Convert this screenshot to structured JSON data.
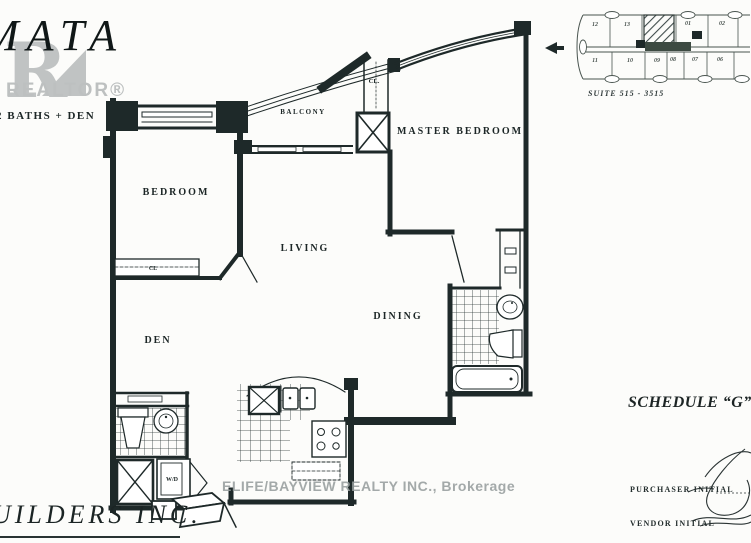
{
  "branding": {
    "logo_text": "MATA",
    "realtor_r": "R",
    "realtor_logo": "REALTOR®",
    "tagline": "2 BATHS + DEN",
    "builder": "UILDERS INC."
  },
  "floorplan": {
    "labels": {
      "balcony": "BALCONY",
      "master_bedroom": "MASTER BEDROOM",
      "bedroom": "BEDROOM",
      "living": "LIVING",
      "dining": "DINING",
      "den": "DEN",
      "closet_master": "CL.",
      "closet_bedroom": "CL",
      "washer_dryer": "W/D"
    }
  },
  "keyplan": {
    "suite_range": "SUITE 515 - 3515",
    "top_units": [
      "12",
      "13",
      "01",
      "02"
    ],
    "bottom_units": [
      "11",
      "10",
      "09",
      "08",
      "07",
      "06"
    ]
  },
  "legal": {
    "schedule": "SCHEDULE “G”",
    "purchaser_label": "PURCHASER INITIAL",
    "vendor_label": "VENDOR INITIAL"
  },
  "watermark": "ELIFE/BAYVIEW REALTY INC., Brokerage",
  "colors": {
    "ink": "#1e2929",
    "logo_gray": "#c0c3c3",
    "watermark_gray": "#969d9d",
    "keyplan_ink": "#49544f",
    "paper": "#fcfcfa"
  }
}
